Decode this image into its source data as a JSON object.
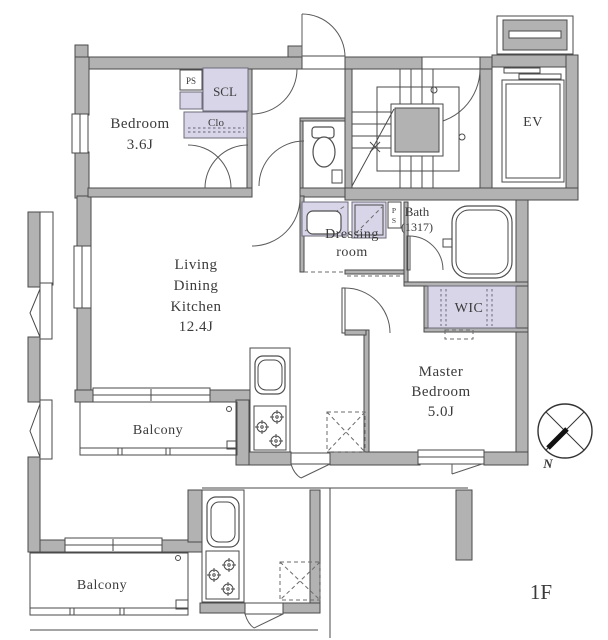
{
  "floor_plan": {
    "floor": "1F",
    "compass": {
      "label": "N"
    },
    "rooms": {
      "bedroom": {
        "name": "Bedroom",
        "size": "3.6J"
      },
      "ldk": {
        "l1": "Living",
        "l2": "Dining",
        "l3": "Kitchen",
        "size": "12.4J"
      },
      "master": {
        "l1": "Master",
        "l2": "Bedroom",
        "size": "5.0J"
      },
      "bath": {
        "name": "Bath",
        "size": "(1317)"
      },
      "dressing": {
        "l1": "Dressing",
        "l2": "room"
      }
    },
    "storage": {
      "wic": "WIC",
      "scl": "SCL",
      "clo": "Clo"
    },
    "shafts": {
      "ps": "PS",
      "ps_p": "P",
      "ps_s": "S"
    },
    "elevator": "EV",
    "balconies": {
      "upper": "Balcony",
      "lower": "Balcony"
    },
    "colors": {
      "wall": "#b2b2b2",
      "storage_fill": "#d9d5e8",
      "line": "#4a4a4a"
    }
  }
}
